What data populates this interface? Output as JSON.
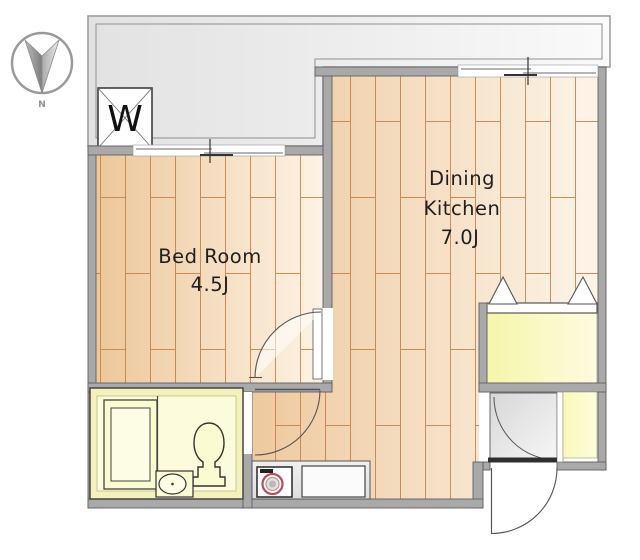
{
  "page": {
    "type": "apartment-floor-plan"
  },
  "rooms": {
    "bedroom": {
      "name": "Bed Room",
      "size": "4.5J"
    },
    "dining_kitchen": {
      "line1": "Dining",
      "line2": "Kitchen",
      "size": "7.0J"
    }
  },
  "symbols": {
    "washing_machine": "W",
    "compass": "N"
  },
  "colors": {
    "wall": "#a9a9a9",
    "plank_line": "#c67d42",
    "wood_dark": "#ecc79a",
    "wood_light": "#fdf3e4",
    "balcony_gray": "#e4e4e4",
    "bath_ring": "#f2f2ba",
    "bath_inner": "#fcfcdc",
    "closet_yellow": "#f6f6ac",
    "genkan_gray": "#dedede",
    "stove_ring": "#b04f5e",
    "door_leaf": "#2f2f2f"
  }
}
